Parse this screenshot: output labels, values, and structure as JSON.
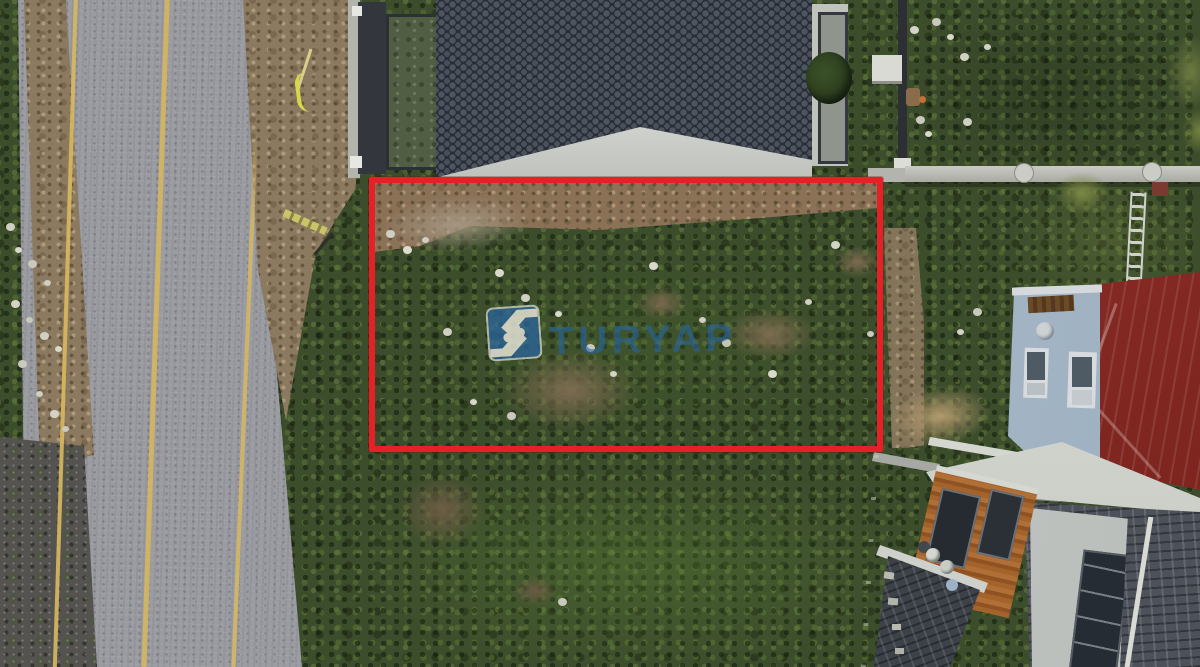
{
  "photo": {
    "caption": "Aerial drone view of a vacant land plot outlined in red, beside a road and houses",
    "watermark": {
      "brand": "TURYAP",
      "logo_icon": "handshake-icon",
      "logo_bg_color": "#2a68a8",
      "text_color": "#2664a4"
    },
    "plot_outline": {
      "shape": "rectangle",
      "color": "#e32127",
      "thickness_px": 6
    },
    "palette": {
      "road_asphalt": "#9b9ca1",
      "road_marking_yellow": "#d7b75e",
      "old_asphalt_dark": "#55534f",
      "dirt_shoulder": "#8c7a60",
      "vegetation_dark": "#3c4d2c",
      "vegetation_bright": "#51682e",
      "villa_roof_dark": "#3b414b",
      "villa_trim_white": "#c9cbc7",
      "courtyard_green": "#515e44",
      "red_metal_roof": "#8a2b24",
      "house_facade_blue_gray": "#aebfd0",
      "shingle_roof_gray": "#4d525a",
      "wood_wall_orange": "#9d5c2a",
      "boundary_wall_gray": "#b5b6b0",
      "fence_green": "#2c4527"
    }
  }
}
